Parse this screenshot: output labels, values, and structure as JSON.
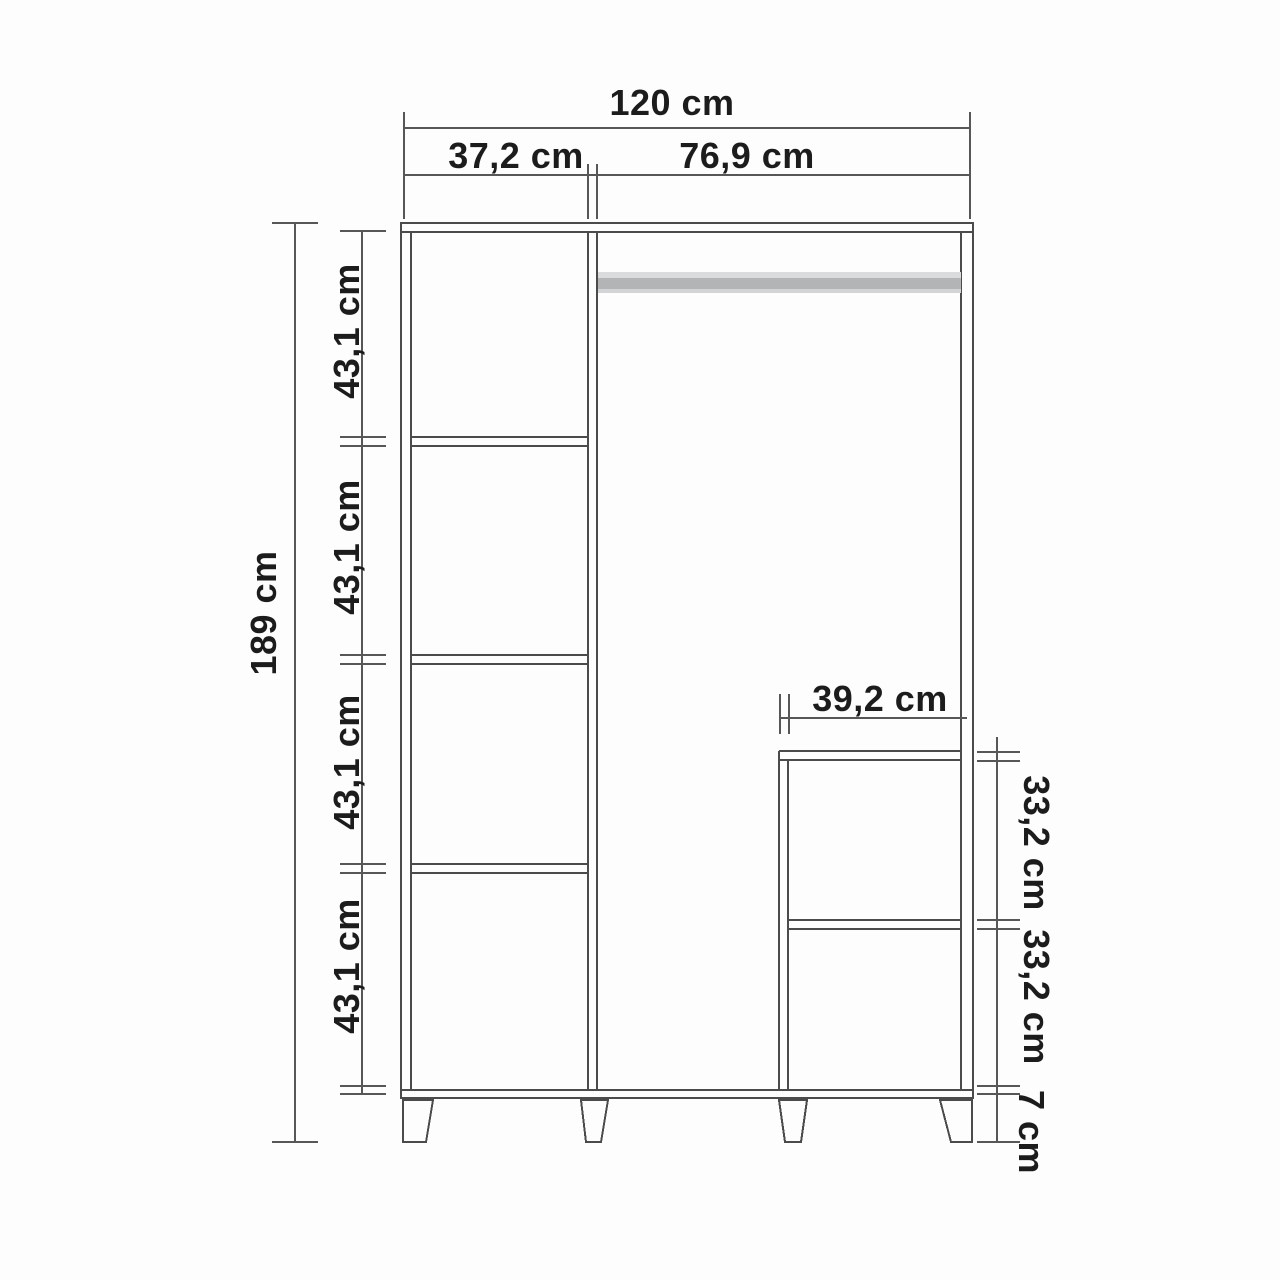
{
  "drawing": {
    "type": "furniture-dimension-diagram",
    "subject": "wardrobe front elevation with interior shelves, hanging rod and lower niche",
    "unit": "cm",
    "labels": {
      "total_width": "120 cm",
      "left_section_width": "37,2 cm",
      "right_section_width": "76,9 cm",
      "total_height": "189 cm",
      "left_compartment_1": "43,1 cm",
      "left_compartment_2": "43,1 cm",
      "left_compartment_3": "43,1 cm",
      "left_compartment_4": "43,1 cm",
      "niche_width": "39,2 cm",
      "niche_height_1": "33,2 cm",
      "niche_height_2": "33,2 cm",
      "feet_height": "7 cm"
    },
    "colors": {
      "structure_line": "#4b4b4b",
      "dimension_line": "#575757",
      "text": "#1c1c1c",
      "rod_fill": "#b2b4b6",
      "background": "#fdfdfd"
    }
  }
}
